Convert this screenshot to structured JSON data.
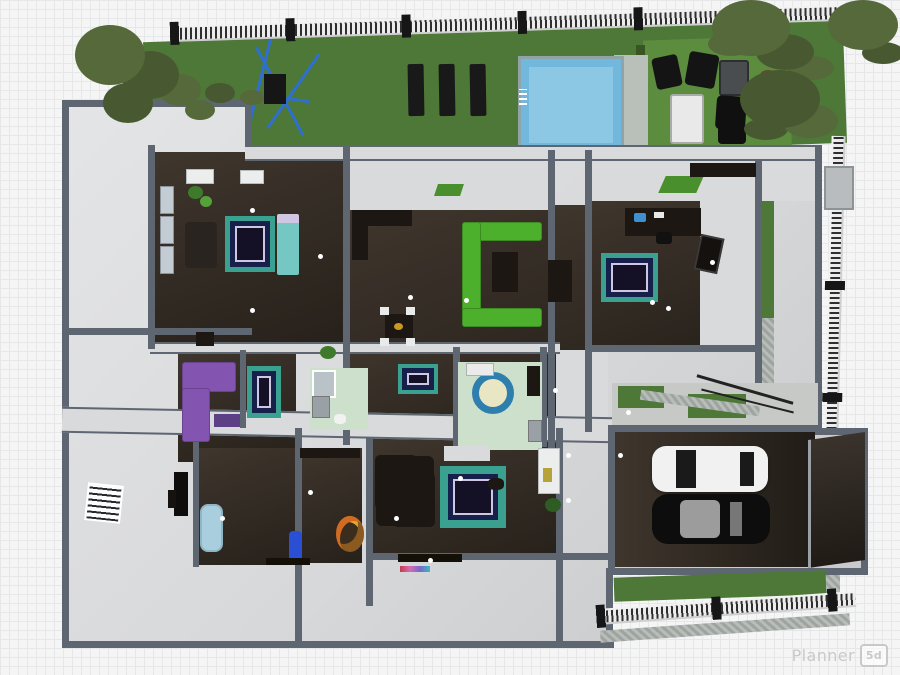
{
  "watermark": {
    "brand": "Planner",
    "badge": "5d"
  },
  "palette": {
    "grid_bg": "#f5f5f6",
    "grid_line": "#e6e7e9",
    "lawn": "#4d7837",
    "patio": "#5c8c3e",
    "hedge": "#3a5524",
    "pool_water": "#72b8dc",
    "pool_inner": "#a2d4ea",
    "pool_deck": "#b9c0ba",
    "deck_edge": "#8fa3a8",
    "floor_dark": "#3f362d",
    "floor_deep": "#27211b",
    "wall_cap": "#5e6672",
    "wall_fill": "#d9dadc",
    "house_light": "#d7d8da",
    "house_lighter": "#e4e5e7",
    "rug_teal": "#3aa08f",
    "rug_navy": "#16204a",
    "rug_lav": "#cfc7e2",
    "rug_center": "#141026",
    "sofa_green": "#4cb02c",
    "mat_green": "#4a8f2e",
    "bed_teal": "#74c7c2",
    "purple": "#8455b0",
    "purple_dark": "#5d3f85",
    "mint": "#cde0cc",
    "round_ring": "#2f7fae",
    "round_center": "#e9e7c3",
    "car_white": "#f1f1f1",
    "car_black": "#0d0d0d",
    "glass_dark": "#1a1a1a",
    "glass_light": "#9c9c9c",
    "tree": "#56693a",
    "tree_dark": "#485931",
    "bush_red": "#6b4732",
    "fence_dark": "#2f2f2f",
    "fence_light": "#ececec",
    "post": "#161616",
    "swing_blue": "#2e6fd0",
    "tub_blue": "#a9cedd",
    "gravel": "#aab0ac",
    "walkway": "#c7c9c7",
    "dark_furn": "#1c1712",
    "white_furn": "#e9eaea",
    "wm": "#c9c9c9"
  },
  "scene": {
    "view": "planner-5d-3d-top-down-floor-plan",
    "outdoor_objects": [
      "back-lawn",
      "pool",
      "pool-deck",
      "sun-loungers",
      "patio-seating",
      "garden-fence",
      "trees",
      "hedge",
      "swing-frame",
      "side-yard-strip",
      "walkway",
      "rear-lawn-strip"
    ],
    "rooms": [
      "terrace-top-left",
      "bedroom-1",
      "living-room",
      "bedroom-2",
      "corridor",
      "hallway",
      "bathroom-1",
      "bathroom-2",
      "lounge-purple",
      "bedroom-3",
      "media-room",
      "family-room",
      "terrace-bottom-left",
      "garage"
    ],
    "furniture": [
      "teal-border-rug-1",
      "teal-border-rug-2",
      "hall-rug",
      "bedroom3-rug",
      "family-room-rug",
      "round-bath-rug",
      "green-sectional-sofa",
      "coffee-table",
      "kitchen-counter",
      "dining-set-small",
      "dining-set-large",
      "piano",
      "desk-with-computer",
      "wall-tv",
      "teal-bed",
      "purple-sofa",
      "wardrobes",
      "shower",
      "washer",
      "toilet",
      "sink",
      "bathtub",
      "sideboard",
      "flower-bouquet",
      "blue-bottle",
      "media-strip",
      "rainbow-mat",
      "white-car",
      "black-car",
      "garage-door",
      "ac-unit"
    ]
  }
}
